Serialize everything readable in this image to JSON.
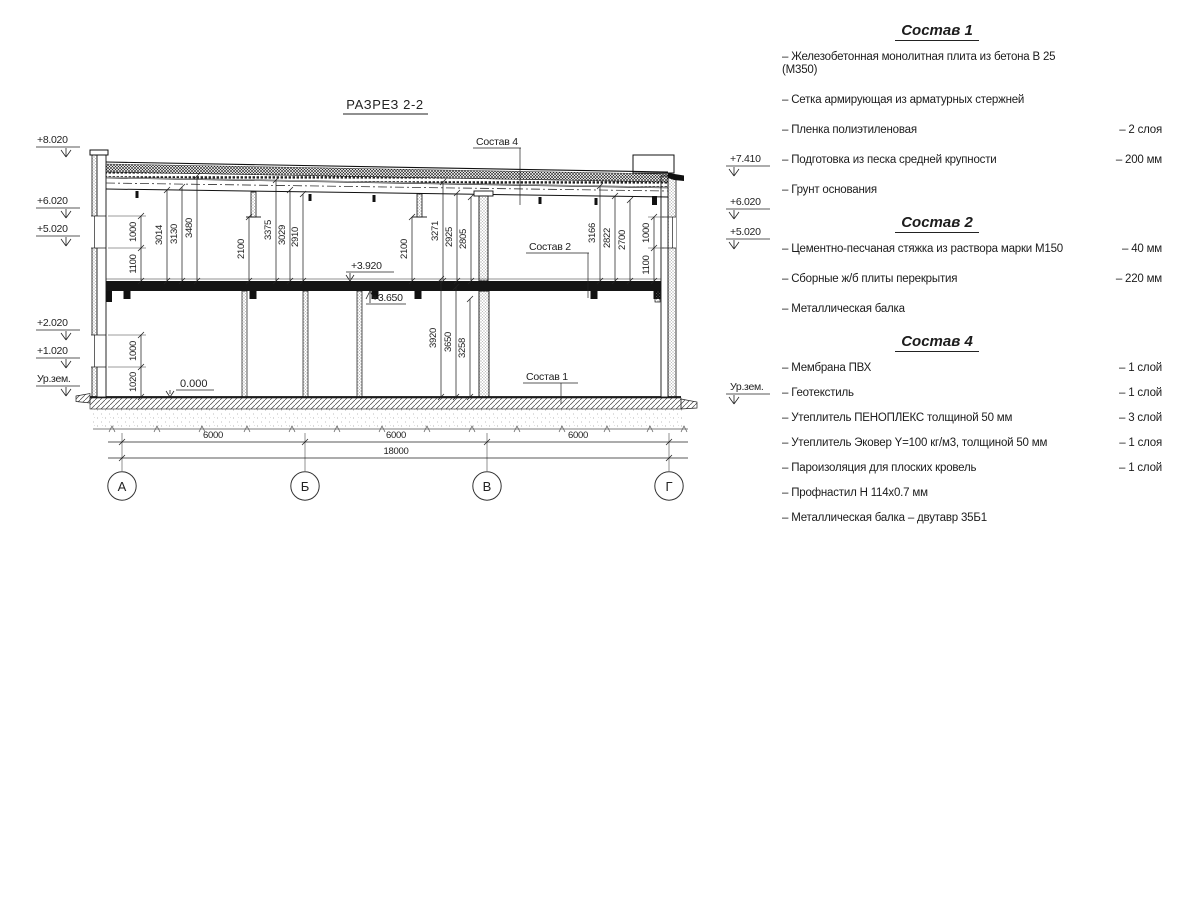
{
  "title": "РАЗРЕЗ 2-2",
  "drawing": {
    "elev": {
      "p8020": "+8.020",
      "p6020": "+6.020",
      "p5020": "+5.020",
      "p2020": "+2.020",
      "p1020": "+1.020",
      "p7410": "+7.410",
      "p3920": "+3.920",
      "p3650": "+3.650",
      "zero": "0.000",
      "ground": "Ур.зем."
    },
    "leaders": {
      "s4": "Состав 4",
      "s2": "Состав 2",
      "s1": "Состав 1"
    },
    "dims": {
      "1000": "1000",
      "1100": "1100",
      "1020": "1020",
      "3014": "3014",
      "3130": "3130",
      "3480": "3480",
      "2100": "2100",
      "3375": "3375",
      "3029": "3029",
      "2910": "2910",
      "3271": "3271",
      "2925": "2925",
      "2805": "2805",
      "3166": "3166",
      "2822": "2822",
      "2700": "2700",
      "3920": "3920",
      "3650": "3650",
      "3258": "3258",
      "6000": "6000",
      "18000": "18000"
    },
    "axes": [
      "А",
      "Б",
      "В",
      "Г"
    ]
  },
  "notes": {
    "s1": {
      "title": "Состав 1",
      "items": [
        {
          "name": "– Железобетонная  монолитная плита из бетона В 25 (М350)",
          "value": ""
        },
        {
          "name": "– Сетка армирующая из арматурных стержней",
          "value": ""
        },
        {
          "name": "– Пленка полиэтиленовая",
          "value": "– 2 слоя"
        },
        {
          "name": "– Подготовка из песка средней крупности",
          "value": "– 200 мм"
        },
        {
          "name": "– Грунт основания",
          "value": ""
        }
      ]
    },
    "s2": {
      "title": "Состав 2",
      "items": [
        {
          "name": "– Цементно-песчаная стяжка из раствора марки М150",
          "value": "– 40 мм"
        },
        {
          "name": "– Сборные ж/б плиты перекрытия",
          "value": "– 220 мм"
        },
        {
          "name": "– Металлическая балка",
          "value": ""
        }
      ]
    },
    "s4": {
      "title": "Состав 4",
      "items": [
        {
          "name": "– Мембрана ПВХ",
          "value": "– 1 слой"
        },
        {
          "name": "– Геотекстиль",
          "value": "– 1 слой"
        },
        {
          "name": "– Утеплитель ПЕНОПЛЕКС толщиной 50 мм",
          "value": "– 3 слой"
        },
        {
          "name": "– Утеплитель Эковер Y=100 кг/м3, толщиной 50 мм",
          "value": "– 1 слоя"
        },
        {
          "name": "– Пароизоляция для плоских кровель",
          "value": "– 1 слой"
        },
        {
          "name": "– Профнастил Н 114х0.7 мм",
          "value": ""
        },
        {
          "name": "– Металлическая балка – двутавр 35Б1",
          "value": ""
        }
      ]
    }
  }
}
